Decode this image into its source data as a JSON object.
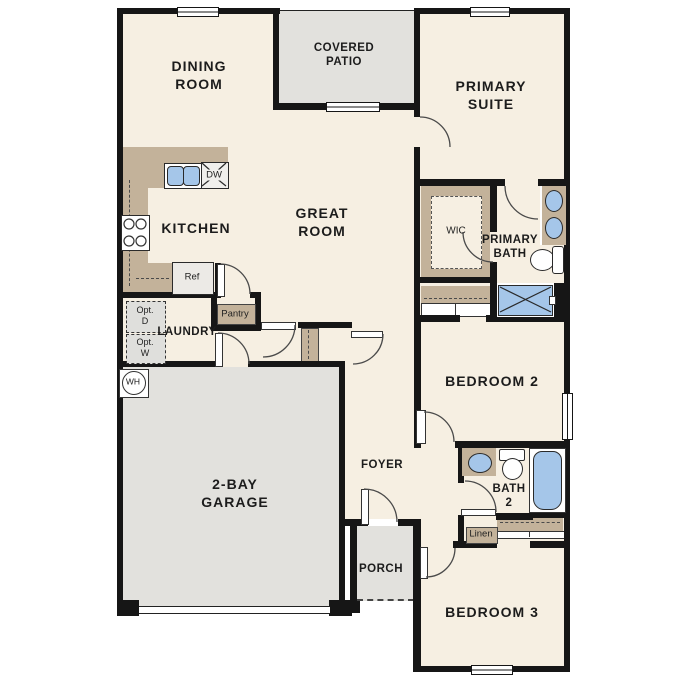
{
  "plan_title": "single-story-floor-plan",
  "rooms": {
    "dining": {
      "l1": "DINING",
      "l2": "ROOM"
    },
    "covered_patio": {
      "l1": "COVERED",
      "l2": "PATIO"
    },
    "primary_suite": {
      "l1": "PRIMARY",
      "l2": "SUITE"
    },
    "kitchen": {
      "l1": "KITCHEN"
    },
    "great_room": {
      "l1": "GREAT",
      "l2": "ROOM"
    },
    "wic": {
      "l1": "WIC"
    },
    "primary_bath": {
      "l1": "PRIMARY",
      "l2": "BATH"
    },
    "laundry": {
      "l1": "LAUNDRY"
    },
    "bedroom2": {
      "l1": "BEDROOM 2"
    },
    "garage": {
      "l1": "2-BAY",
      "l2": "GARAGE"
    },
    "foyer": {
      "l1": "FOYER"
    },
    "bath2": {
      "l1": "BATH",
      "l2": "2"
    },
    "porch": {
      "l1": "PORCH"
    },
    "bedroom3": {
      "l1": "BEDROOM 3"
    }
  },
  "fixtures": {
    "pantry": "Pantry",
    "ref": "Ref",
    "dw": "DW",
    "linen": "Linen",
    "wh": "WH",
    "opt_dryer": {
      "l1": "Opt.",
      "l2": "D"
    },
    "opt_washer": {
      "l1": "Opt.",
      "l2": "W"
    }
  },
  "colors": {
    "floor": "#f6efe2",
    "hard_surface": "#e2e1dd",
    "casework_tan": "#c3b29a",
    "plumbing_blue": "#a5c6e9",
    "wall_black": "#161616",
    "option_gray": "#dfdfdc"
  }
}
